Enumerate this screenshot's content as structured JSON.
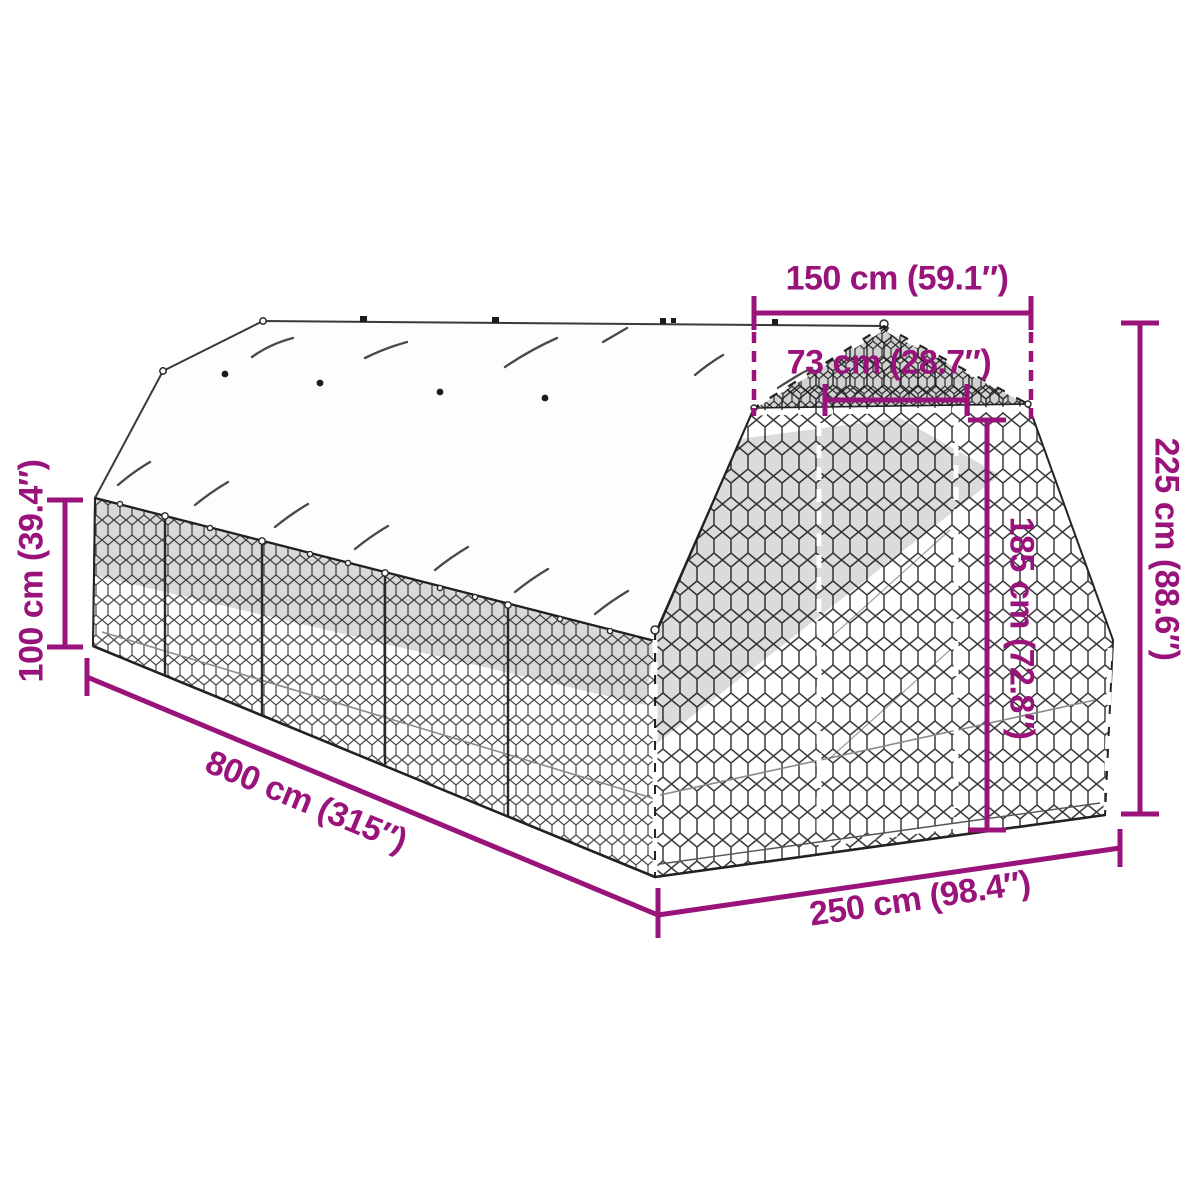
{
  "diagram": {
    "accent_color": "#99137B",
    "ink_color": "#222222",
    "subject": "chicken-run-with-tarp-roof-dimension-diagram",
    "labels": {
      "top_width": "150 cm (59.1″)",
      "door_width": "73 cm (28.7″)",
      "total_height": "225 cm (88.6″)",
      "door_height": "185 cm (72.8″)",
      "wall_height": "100 cm (39.4″)",
      "length": "800 cm (315″)",
      "end_width": "250 cm (98.4″)"
    }
  }
}
